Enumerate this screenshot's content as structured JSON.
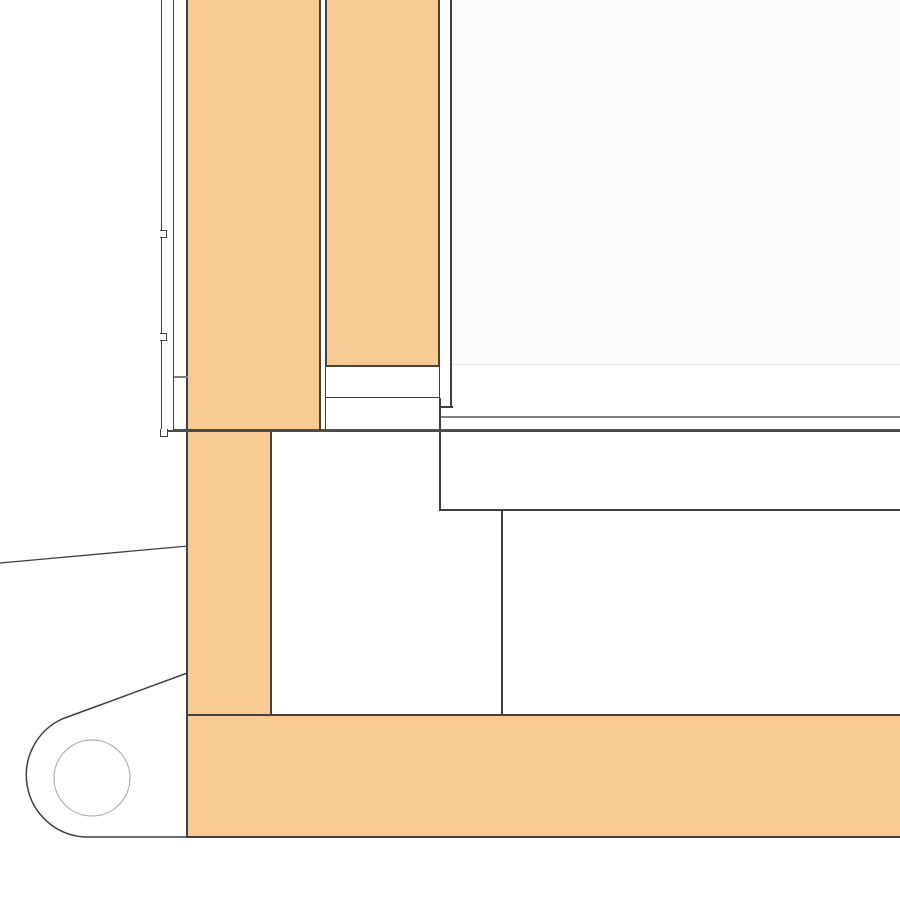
{
  "colors": {
    "background": "#FFFFFF",
    "wood_fill": "#FACA94",
    "wood_edge": "#46423A",
    "line_dark": "#3F3F3F",
    "line_medium": "#81807E",
    "line_heavy": "#4F4C48",
    "line_light": "#AEAEAE",
    "panel_tint": "#FBFDFB",
    "panel_edge": "#E2E6E2"
  }
}
